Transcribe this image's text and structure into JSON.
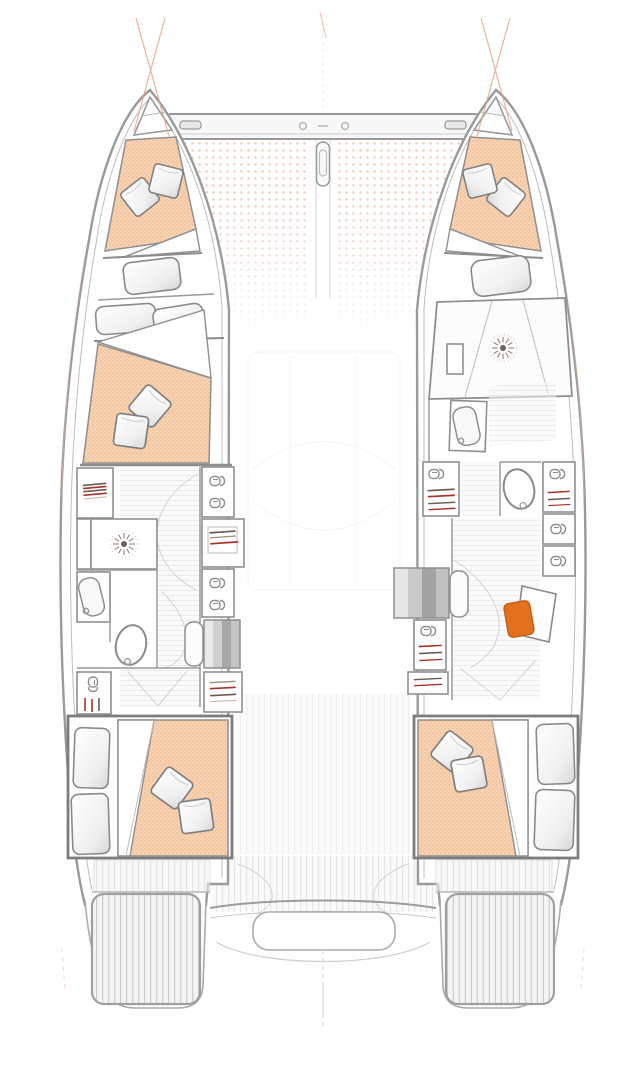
{
  "figure": {
    "kind": "catamaran-deck-floor-plan",
    "view": "top-down, bow up, line drawing, no text labels",
    "hulls": 2,
    "double_berth_cabins": 4,
    "bow_vberth_cabins": 2,
    "aft_cabins": 2,
    "shower_drains": 2,
    "toilets": 2,
    "sinks": 2,
    "wardrobe_lockers": 10,
    "companionway_stairs": 2,
    "trampoline": true,
    "forward_crossbeam": true,
    "swim_platforms": 2,
    "desk_with_stool": 1,
    "pillows_per_double_berth": 2
  },
  "colors": {
    "background": "#ffffff",
    "mattress_base": "#f8d2b0",
    "mattress_dot": "#e9ae85",
    "mattress_dot2": "#edbd97",
    "trampoline_dot": "#f0c9ba",
    "hull_outline": "#9a9a9a",
    "wall_line": "#8c8c8c",
    "bulkhead_dark": "#7d7d7d",
    "floor_slat": "#dcdcdc",
    "deck_slat": "#cdcdcd",
    "cushion_shade": "#d8d8d8",
    "steps_dark": "#a8a8a8",
    "stool_accent": "#e2711d",
    "stool_edge": "#c05f14",
    "hanger_red": "#a83228",
    "hanger_dark": "#6b5b52",
    "shelf_light": "#c8b8ab",
    "rigging_orange": "#e8a183",
    "drain_center": "#6f6257"
  }
}
